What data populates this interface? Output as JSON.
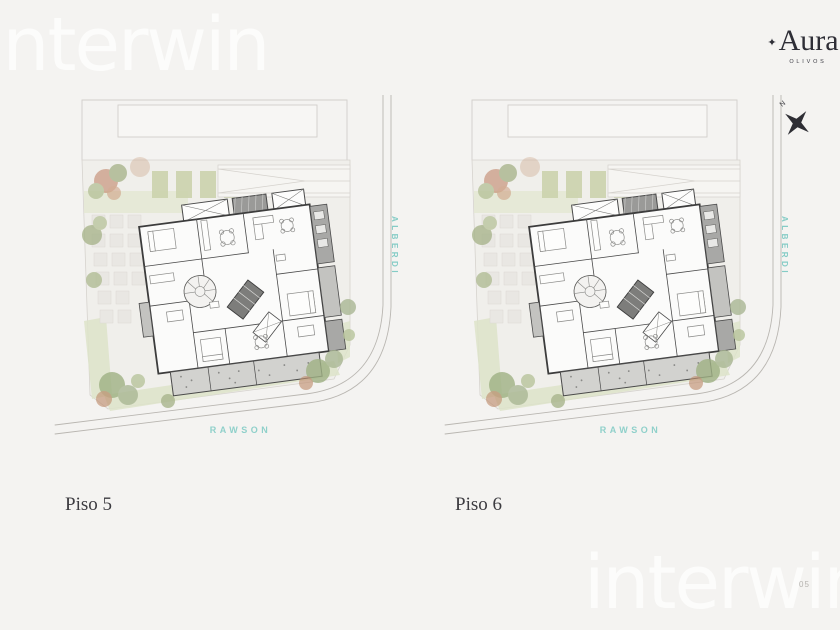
{
  "brand": {
    "watermark": "interwin",
    "logo_star": "✦",
    "logo_name": "Aura",
    "logo_sub": "OLIVOS"
  },
  "compass": {
    "label": "N"
  },
  "page": {
    "number": "05"
  },
  "plans": [
    {
      "caption": "Piso 5",
      "street_side": "ALBERDI",
      "street_bottom": "RAWSON"
    },
    {
      "caption": "Piso 6",
      "street_side": "ALBERDI",
      "street_bottom": "RAWSON"
    }
  ],
  "colors": {
    "background": "#f4f3f1",
    "street_label_teal": "#85ccc6",
    "logo_dark": "#2e2e36",
    "caption_dark": "#3c3b40",
    "garden_green": "#dde3c9",
    "tree_green": "#9fb184",
    "tree_rust": "#c08468",
    "wall_dark": "#3c3c3c",
    "balcony_gray": "#d2d2cf"
  }
}
